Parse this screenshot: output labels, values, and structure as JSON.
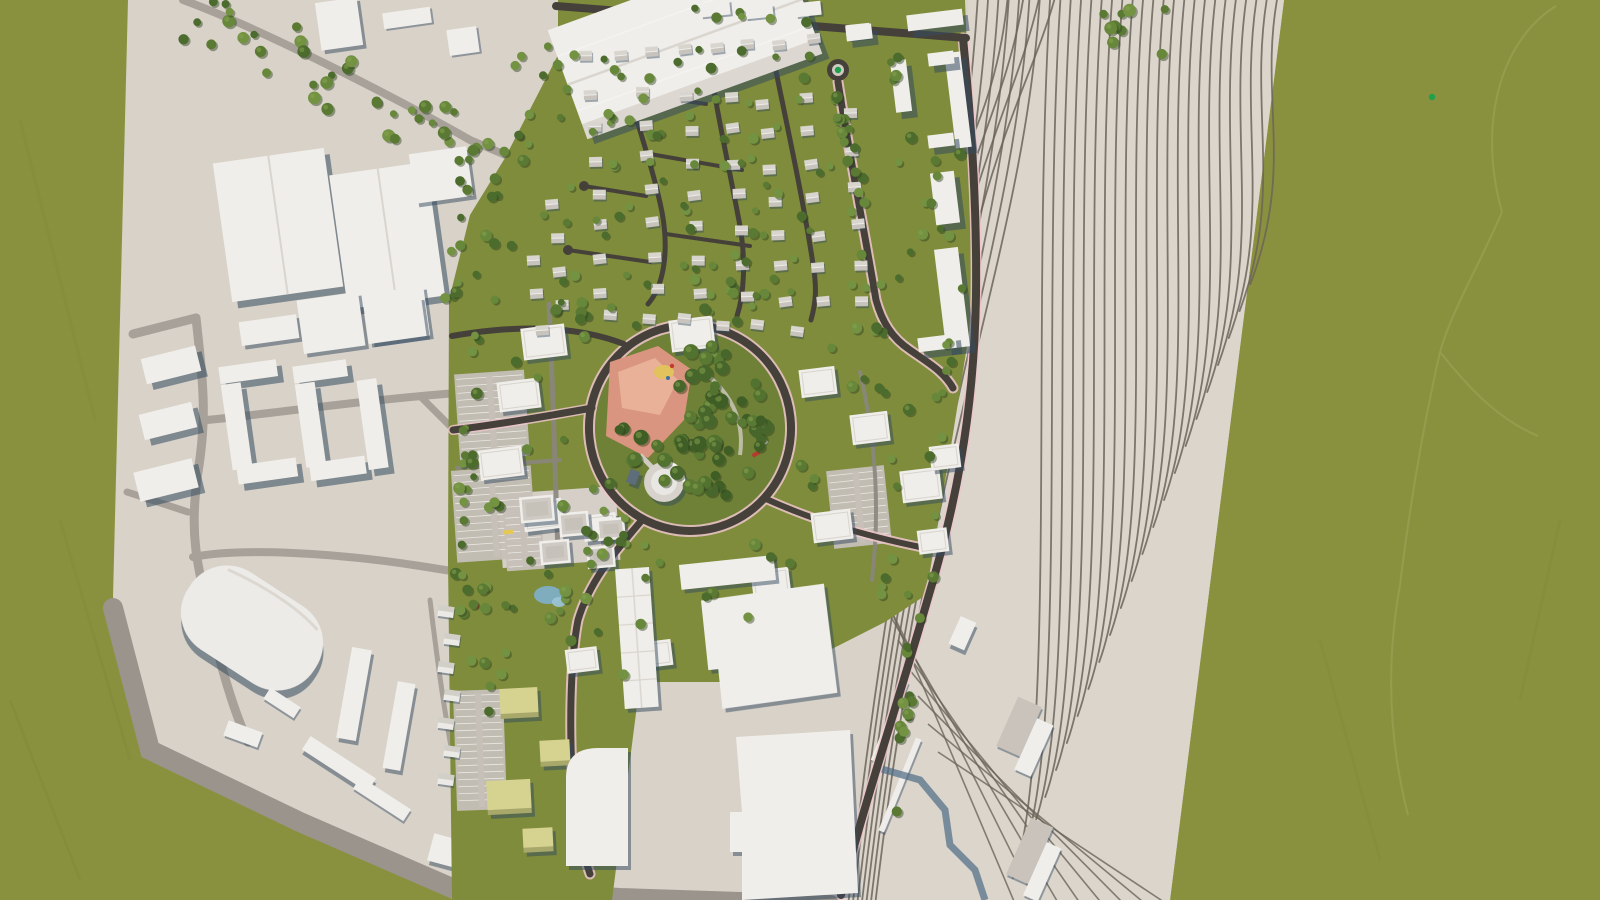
{
  "scene": {
    "kind": "aerial-3d-masterplan-render",
    "description": "Top-down bird's-eye render of an urban regeneration masterplan: a new residential quarter with curving streets and gabled houses, a central park with salmon plaza and playground, an office/apartment grid, a commercial strip, industrial context buildings to the west and south, and a fanning railway yard to the east, all on a light model base surrounded by olive-green open fields.",
    "visible_text": [],
    "interaction_hint": "3d-viewport (orbit/pan/zoom)"
  },
  "palette": {
    "bg": "#8A913E",
    "bgStreak": "#7E883A",
    "plane": "#D8D2C9",
    "rail": "#DBD5CC",
    "track": "#6B6459",
    "roadDark": "#45413A",
    "roadGrey": "#A7A19A",
    "roadLane": "#8B867F",
    "perimeter": "#9A948D",
    "pink": "#EFC6CD",
    "building": "#F0EEEA",
    "roof": "#CFCBC4",
    "roofDark": "#BDB7AE",
    "shade": "#5E7081",
    "devGreen": "#7E8C3B",
    "parkGreen": "#6F8136",
    "plaza": "#D9957F",
    "plazaLight": "#EBB89F",
    "yellow": "#D6D391",
    "yellowShade": "#A8A86A",
    "water": "#7FB0CC",
    "bright": "#1FA04A",
    "navy": "#27303F",
    "parking": "#C6C0B8",
    "stripe": "#EAE7E2",
    "faintPath": "#9AA457",
    "treeGreens": [
      "#5A7A34",
      "#67883B",
      "#739242",
      "#4C6C2D"
    ],
    "parkTreeGreens": [
      "#47662B",
      "#52732F",
      "#3F5E26",
      "#5A7A34"
    ],
    "treeShadow": "#2F4020"
  },
  "counts": {
    "rail_tracks_fan": 30,
    "rail_tracks_diagonal": 8,
    "rail_tracks_hooks": 4,
    "houses": 69,
    "trees_total": 387,
    "grid_buildings": 16,
    "east_slab_buildings": 9,
    "commercial_buildings": 5,
    "yellow_buildings": 4,
    "context_small_houses": 7,
    "parking_lots": 5
  },
  "regions": {
    "background": {
      "label": "open-fields"
    },
    "ground_plane": {
      "label": "site-model-base"
    },
    "railway_yard": {
      "label": "railway-yard-track-fan"
    },
    "context_west": {
      "label": "existing-industrial-and-housing-context"
    },
    "stadium": {
      "label": "oval-hall-building"
    },
    "warehouse": {
      "label": "large-warehouse-building"
    },
    "residential": {
      "label": "new-housing-quarter"
    },
    "central_park": {
      "label": "central-park-plaza-playground"
    },
    "roundabout": {
      "label": "roundabout-with-tree"
    },
    "grid_district": {
      "label": "office-apartment-grid"
    },
    "commercial_strip": {
      "label": "commercial-strip-with-water-feature"
    },
    "yellow_district": {
      "label": "mixed-use-yellow-buildings"
    },
    "industrial_south": {
      "label": "large-flat-industrial-halls"
    },
    "green_margin_paths": {
      "label": "faint-field-paths"
    }
  }
}
